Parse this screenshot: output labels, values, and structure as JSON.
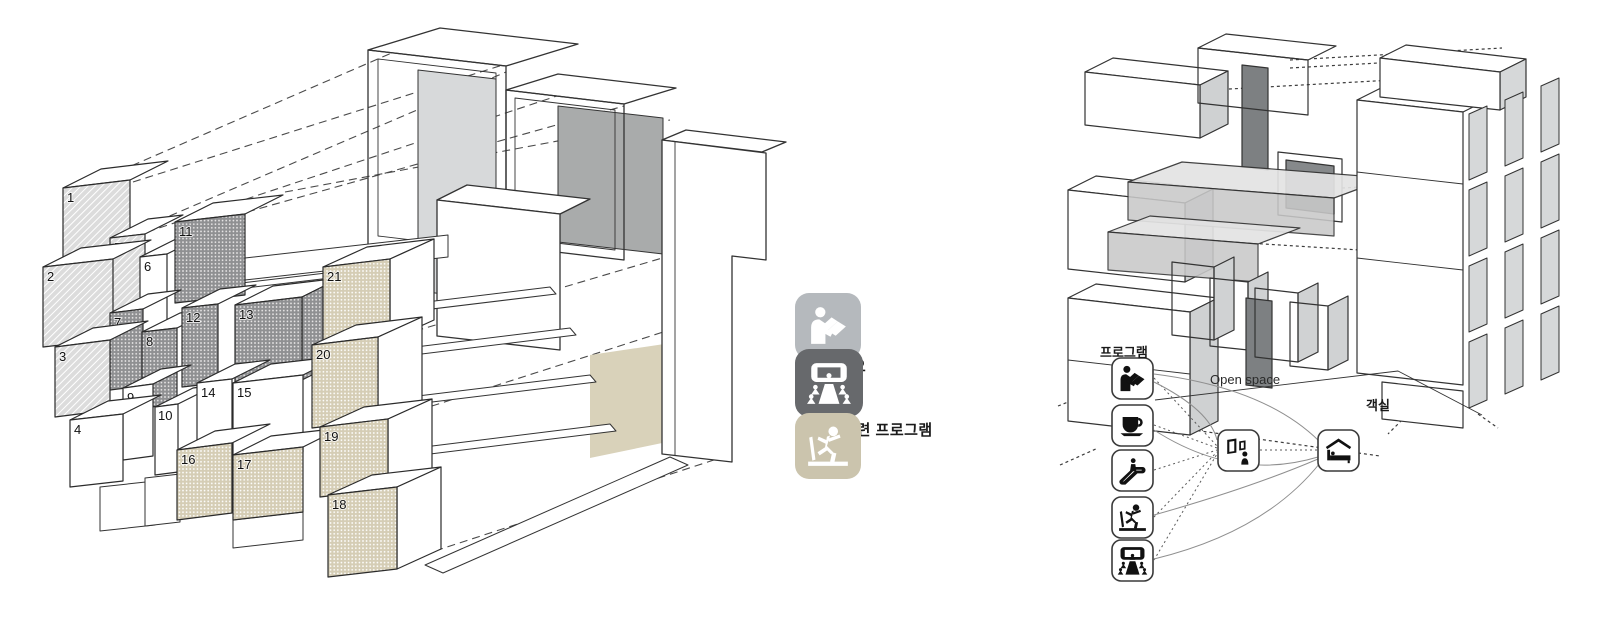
{
  "title": "program-massing-diagram",
  "legend": {
    "items": [
      {
        "label": "도서관",
        "color": "#b5b9bd",
        "icon": "book-reader-icon"
      },
      {
        "label": "스튜디오",
        "color": "#67696c",
        "icon": "studio-audience-icon"
      },
      {
        "label": "건강 관련 프로그램",
        "color": "#cbc4ad",
        "icon": "treadmill-runner-icon"
      }
    ]
  },
  "left_diagram": {
    "description": "exploded axonometric of numbered program blocks",
    "boxes": [
      {
        "num": "1",
        "category": "library"
      },
      {
        "num": "2",
        "category": "library"
      },
      {
        "num": "3",
        "category": "library"
      },
      {
        "num": "4",
        "category": "plain"
      },
      {
        "num": "5",
        "category": "library"
      },
      {
        "num": "6",
        "category": "plain"
      },
      {
        "num": "7",
        "category": "studio"
      },
      {
        "num": "8",
        "category": "studio"
      },
      {
        "num": "9",
        "category": "plain"
      },
      {
        "num": "10",
        "category": "plain"
      },
      {
        "num": "11",
        "category": "studio"
      },
      {
        "num": "12",
        "category": "studio"
      },
      {
        "num": "13",
        "category": "studio"
      },
      {
        "num": "14",
        "category": "plain"
      },
      {
        "num": "15",
        "category": "plain"
      },
      {
        "num": "16",
        "category": "health"
      },
      {
        "num": "17",
        "category": "health"
      },
      {
        "num": "18",
        "category": "health"
      },
      {
        "num": "19",
        "category": "health"
      },
      {
        "num": "20",
        "category": "health"
      },
      {
        "num": "21",
        "category": "health"
      }
    ],
    "pattern_colors": {
      "library_hatch": "#dcdcdc",
      "studio_dots": "#8f9092",
      "health_dots": "#d5cdb5"
    }
  },
  "right_diagram": {
    "labels": {
      "program": "프로그램",
      "open_space": "Open space",
      "guest_room": "객실"
    },
    "program_icons": [
      {
        "name": "book-reader-icon"
      },
      {
        "name": "cafe-cup-icon"
      },
      {
        "name": "escalator-icon"
      },
      {
        "name": "treadmill-runner-icon"
      },
      {
        "name": "studio-audience-icon"
      }
    ],
    "hub_icon": "gallery-viewing-icon",
    "destination_icon": "guest-room-bed-icon",
    "panel_colors": {
      "light": "#d6d8d9",
      "mid": "#c9c9c9",
      "dark": "#7d8082"
    }
  }
}
